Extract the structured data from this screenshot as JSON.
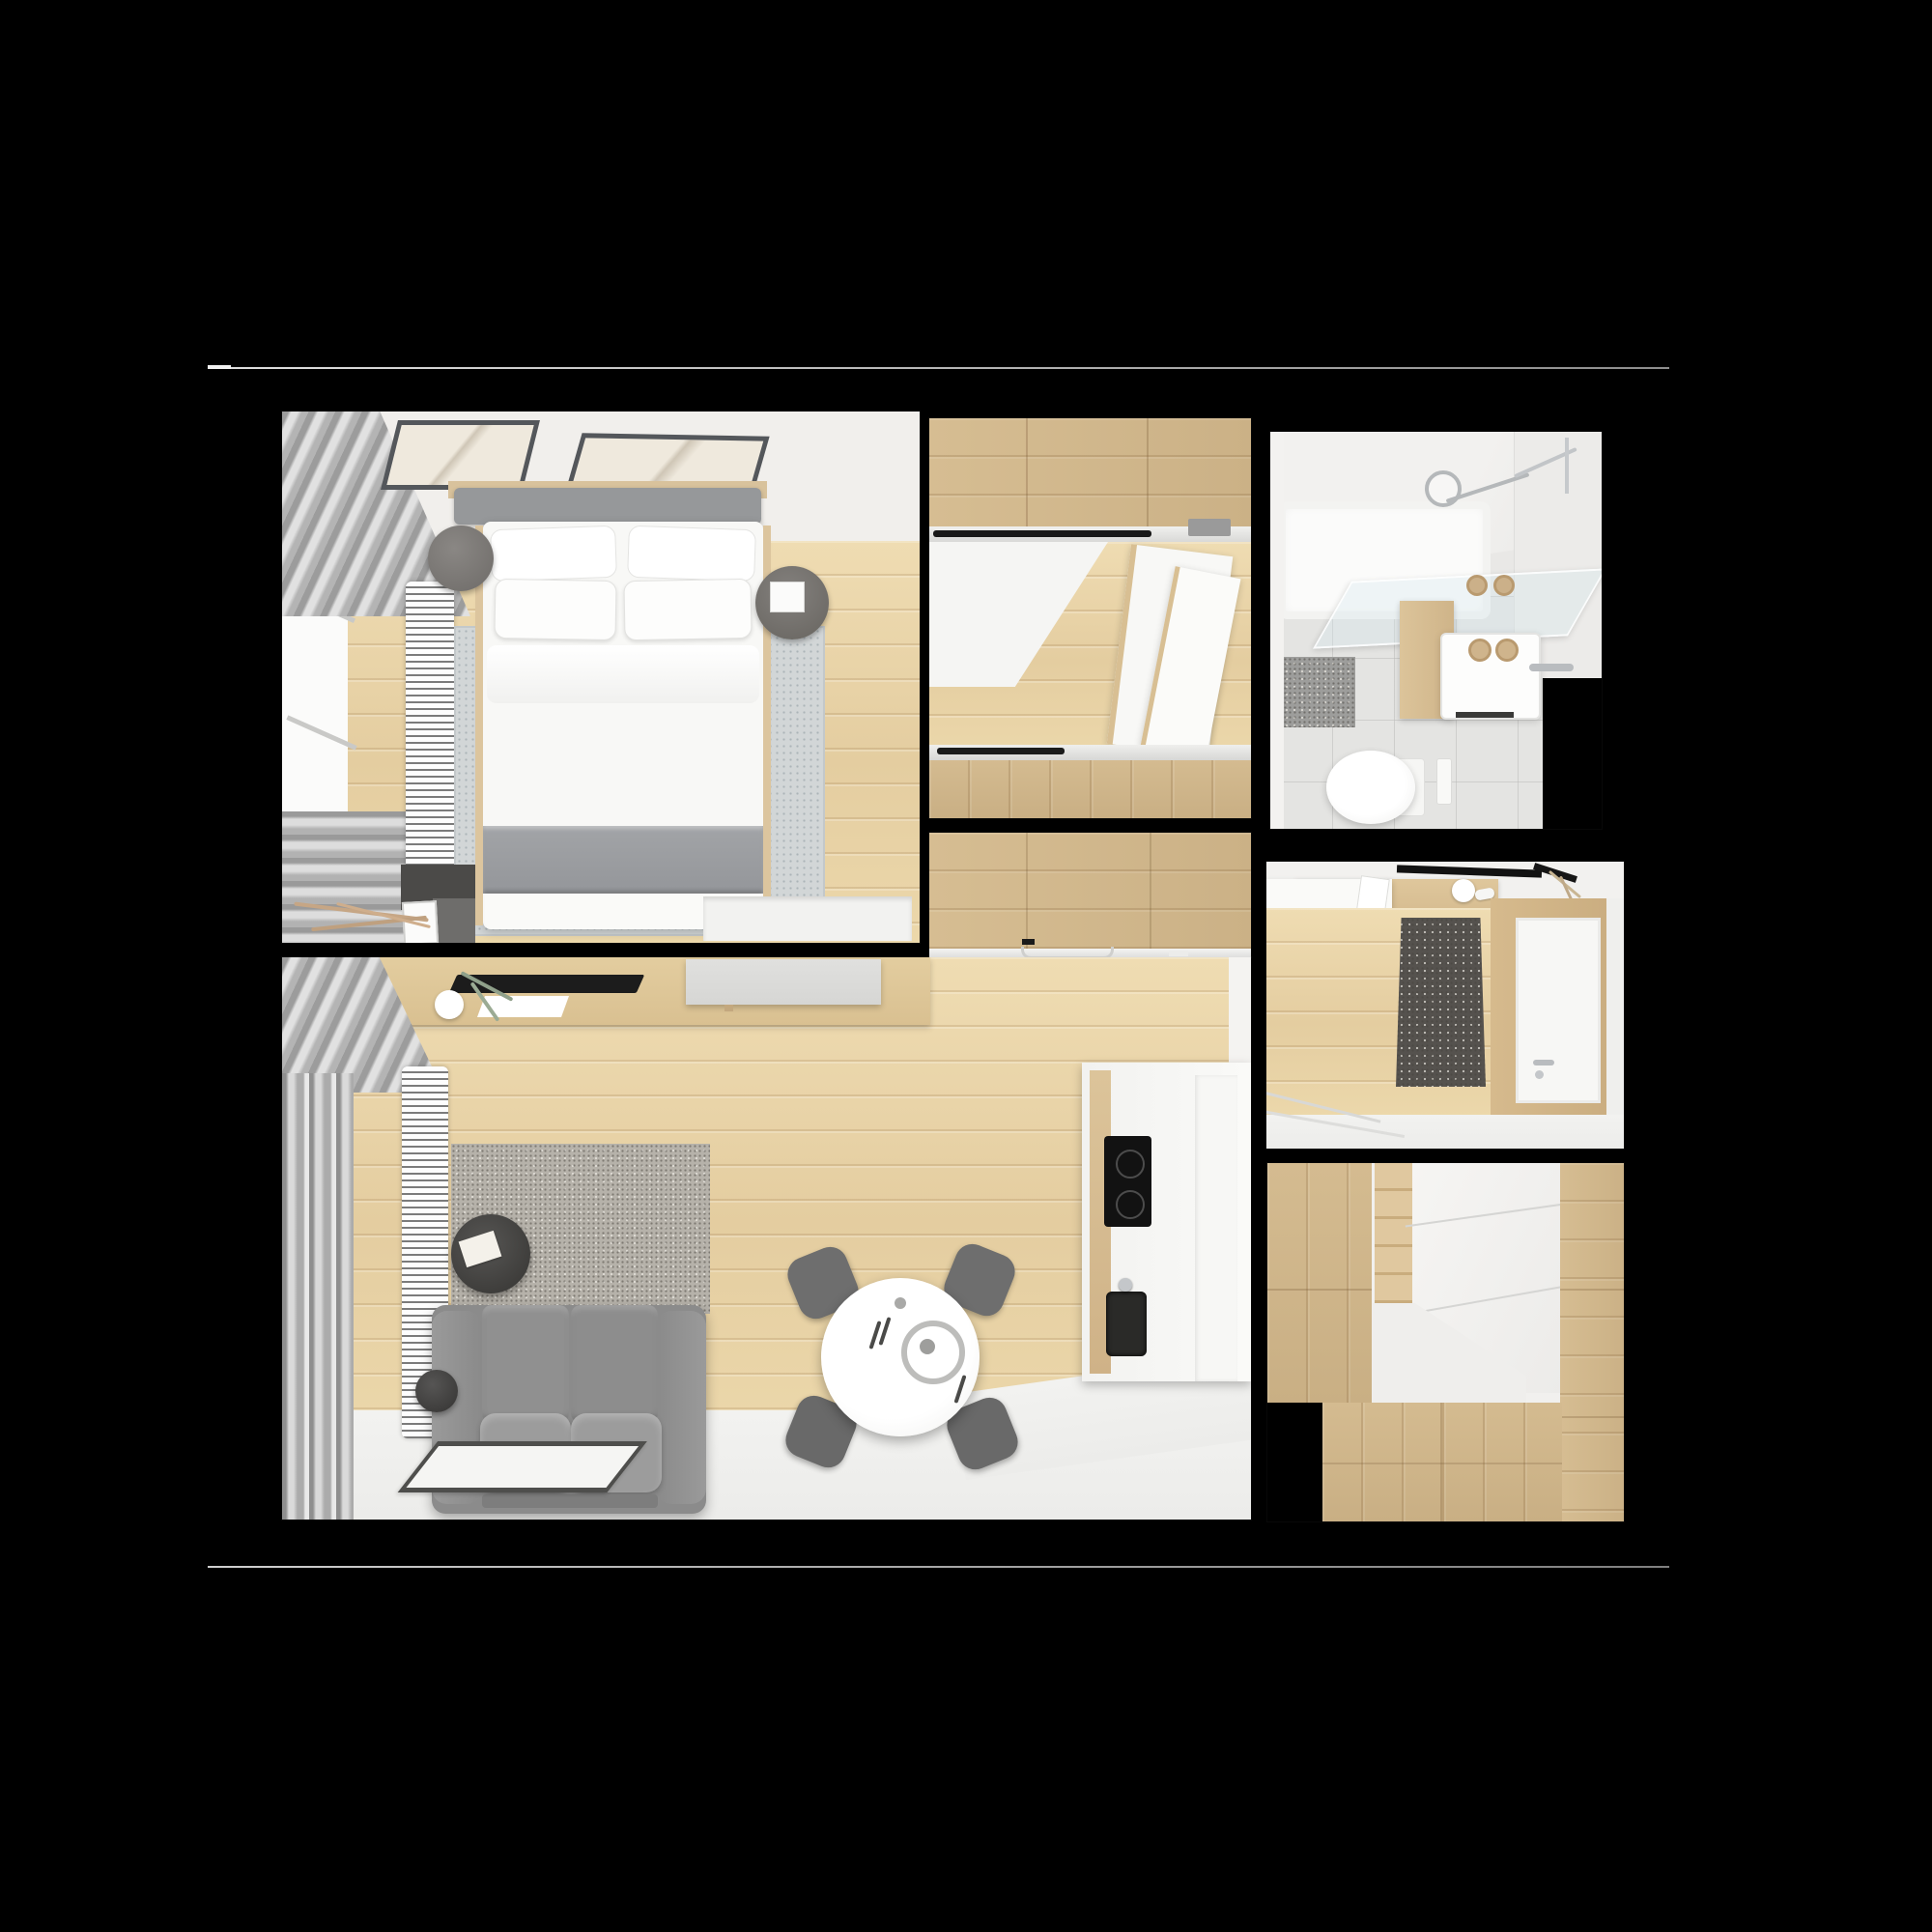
{
  "scene": {
    "kind": "apartment-top-down-3d-render-collage",
    "background": "#000000",
    "divider_line_color": "#b9b9b9"
  },
  "palette": {
    "floor_wood": "#e8d3a7",
    "cabinet_wood": "#cdb388",
    "wall_white": "#f1efec",
    "tile_gray": "#e4e4e2",
    "sofa_gray": "#8f8f8f",
    "blanket_gray": "#9b9da0",
    "mat_dark": "#55524e",
    "accent_black": "#1b1b1b",
    "chrome": "#b9bcbf"
  },
  "panels": [
    {
      "id": "bedroom",
      "label": "bedroom top view"
    },
    {
      "id": "hallway-wardrobe",
      "label": "hallway sliding wardrobe top view"
    },
    {
      "id": "bathroom",
      "label": "bathroom top view"
    },
    {
      "id": "kitchen-strip",
      "label": "kitchen cabinets top view"
    },
    {
      "id": "living-room",
      "label": "living room and kitchen top view"
    },
    {
      "id": "entry",
      "label": "entry hall top view"
    },
    {
      "id": "closet",
      "label": "closet nook top view"
    }
  ]
}
